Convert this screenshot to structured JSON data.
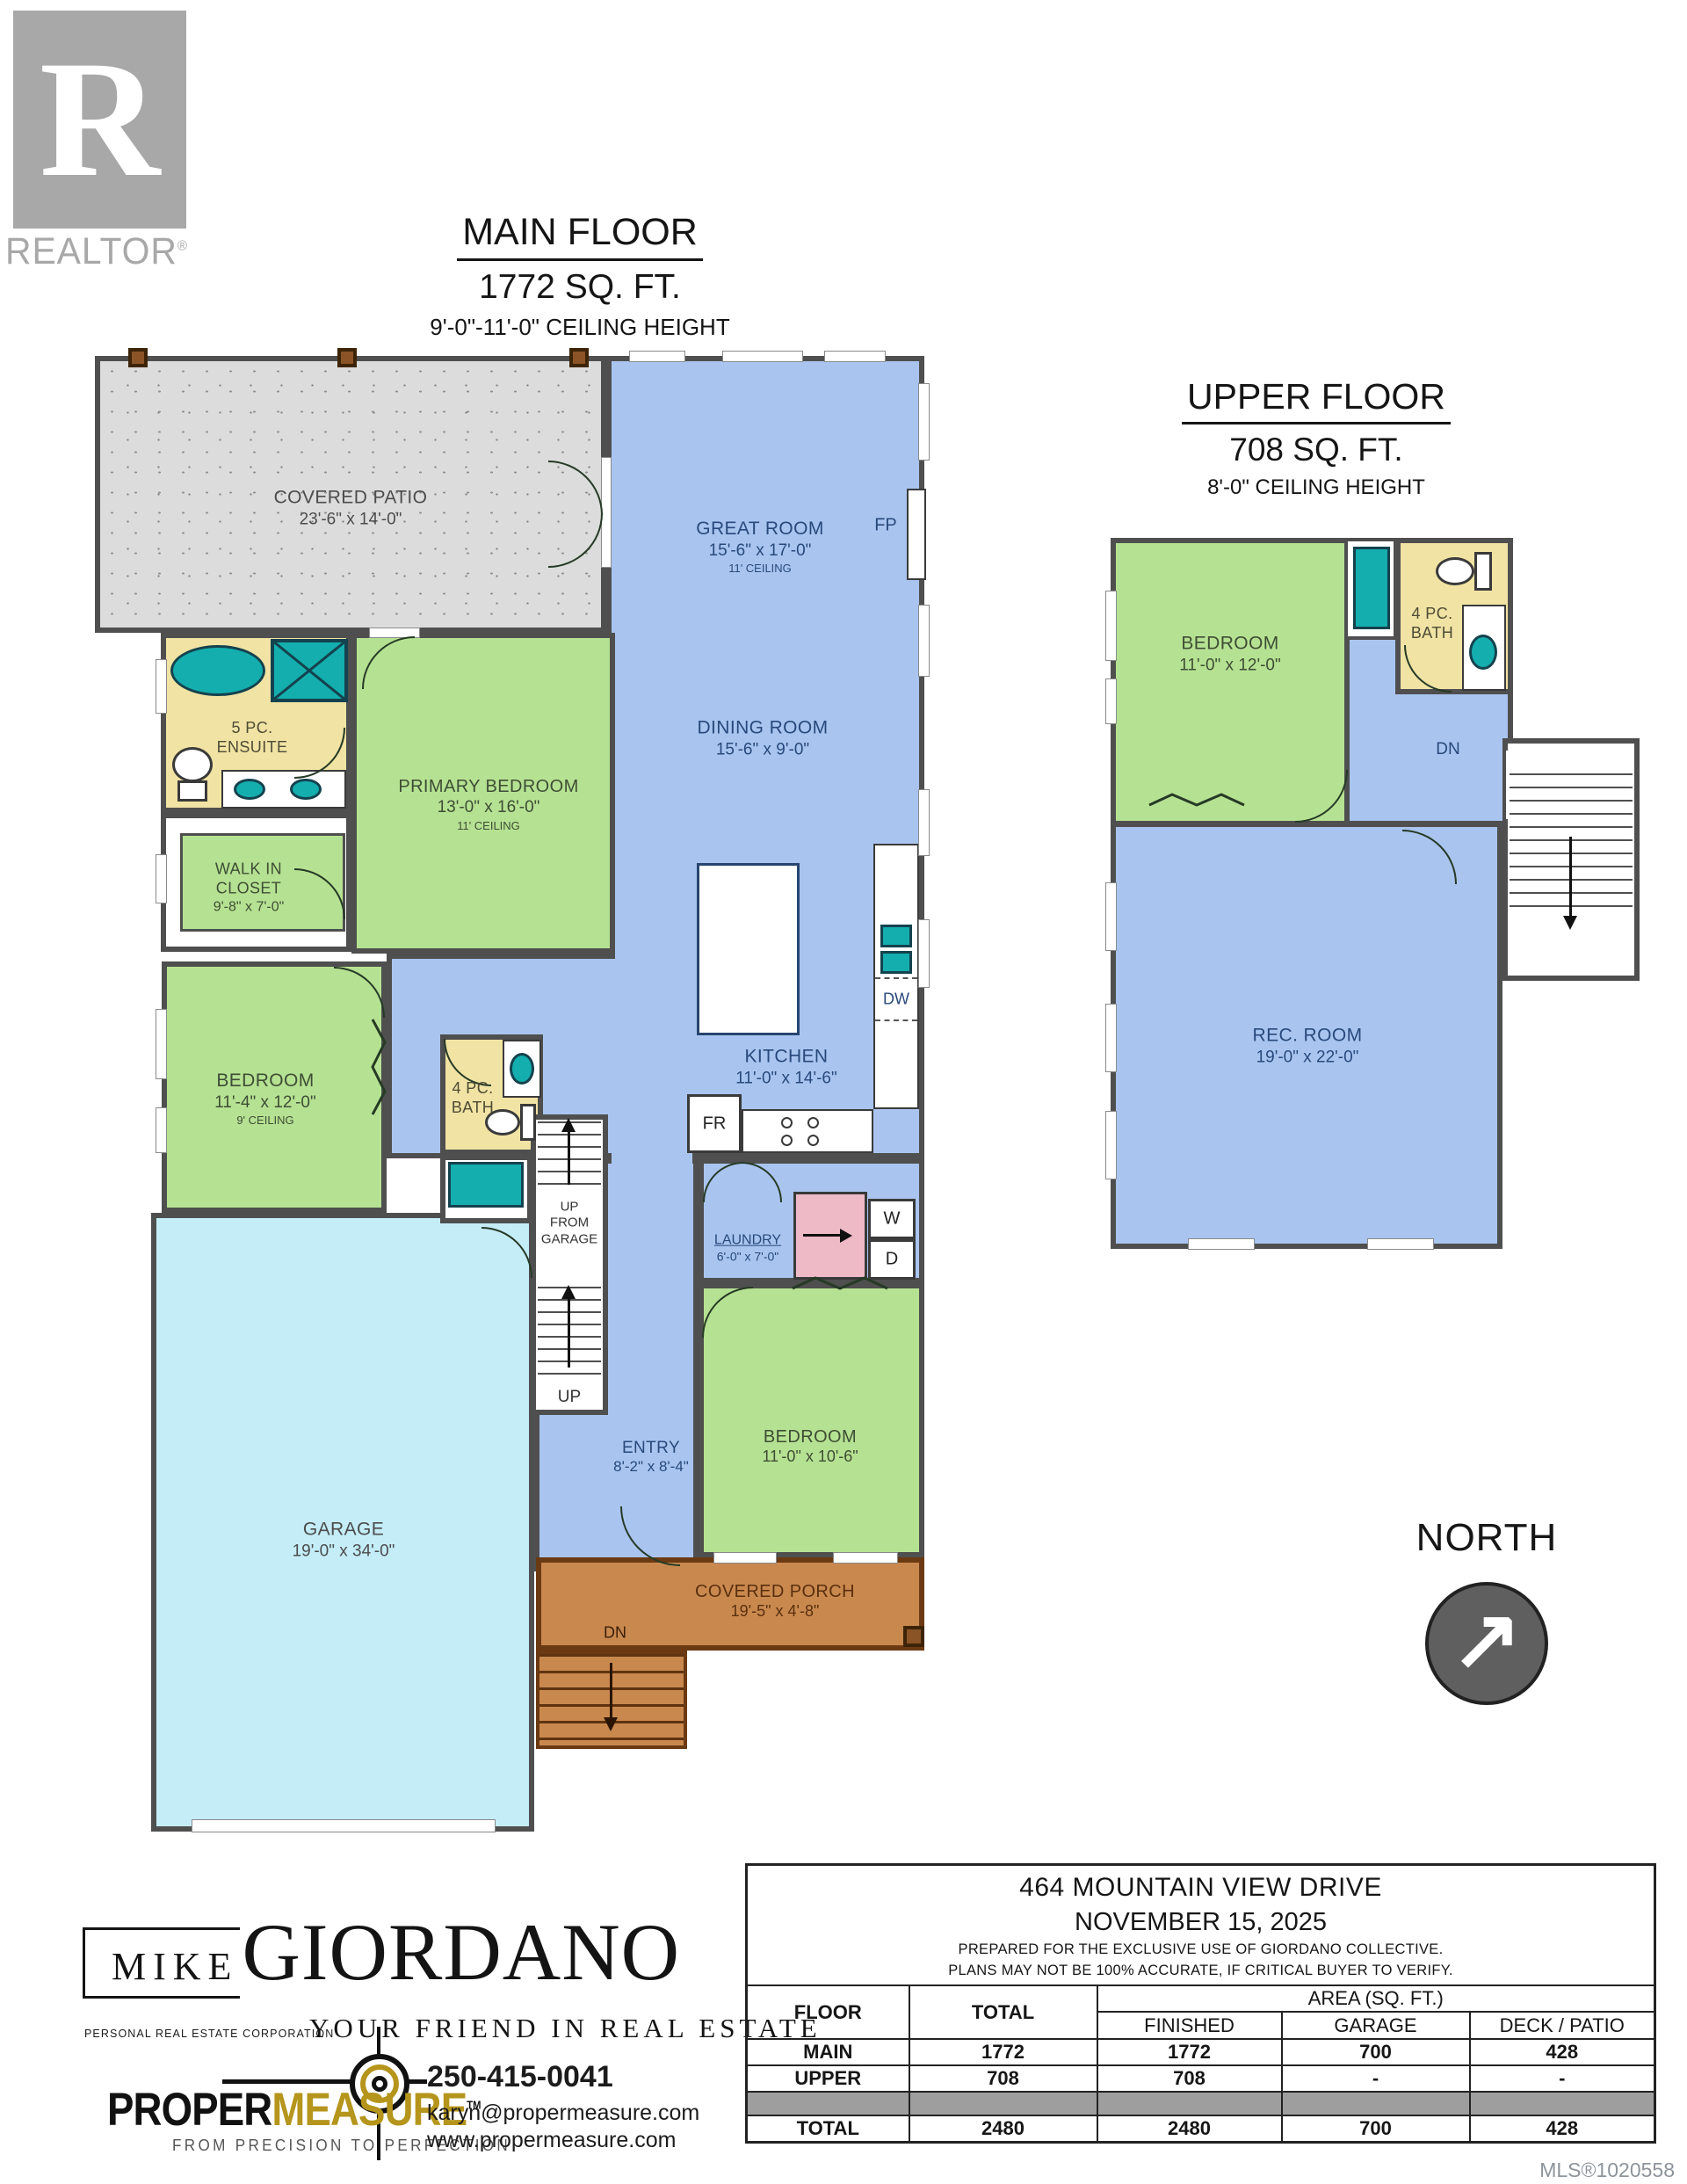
{
  "branding": {
    "realtor": {
      "letter": "R",
      "label": "REALTOR",
      "reg": "®"
    },
    "giordano": {
      "first": "MIKE",
      "last": "GIORDANO",
      "subtitle": "PERSONAL REAL ESTATE CORPORATION",
      "tagline": "YOUR FRIEND IN REAL ESTATE"
    },
    "propermeasure": {
      "word1": "PROPER",
      "word2": "MEASURE",
      "tm": "TM",
      "tagline": "FROM PRECISION TO PERFECTION",
      "phone": "250-415-0041",
      "email": "karyn@propermeasure.com",
      "website": "www.propermeasure.com"
    }
  },
  "main_floor": {
    "title": "MAIN FLOOR",
    "area": "1772 SQ. FT.",
    "ceiling": "9'-0\"-11'-0\" CEILING HEIGHT",
    "rooms": {
      "covered_patio": {
        "name": "COVERED PATIO",
        "dims": "23'-6\" x 14'-0\""
      },
      "great_room": {
        "name": "GREAT ROOM",
        "dims": "15'-6\" x 17'-0\"",
        "ceiling": "11' CEILING"
      },
      "dining_room": {
        "name": "DINING ROOM",
        "dims": "15'-6\" x 9'-0\""
      },
      "ensuite": {
        "line1": "5 PC.",
        "line2": "ENSUITE"
      },
      "primary_bedroom": {
        "name": "PRIMARY BEDROOM",
        "dims": "13'-0\" x 16'-0\"",
        "ceiling": "11' CEILING"
      },
      "walk_in_closet": {
        "line1": "WALK IN",
        "line2": "CLOSET",
        "dims": "9'-8\" x 7'-0\""
      },
      "bedroom2": {
        "name": "BEDROOM",
        "dims": "11'-4\" x 12'-0\"",
        "ceiling": "9' CEILING"
      },
      "bath": {
        "line1": "4 PC.",
        "line2": "BATH"
      },
      "kitchen": {
        "name": "KITCHEN",
        "dims": "11'-0\" x 14'-6\""
      },
      "laundry": {
        "name": "LAUNDRY",
        "dims": "6'-0\" x 7'-0\""
      },
      "entry": {
        "name": "ENTRY",
        "dims": "8'-2\" x 8'-4\""
      },
      "bedroom3": {
        "name": "BEDROOM",
        "dims": "11'-0\" x 10'-6\""
      },
      "garage": {
        "name": "GARAGE",
        "dims": "19'-0\" x 34'-0\""
      },
      "covered_porch": {
        "name": "COVERED PORCH",
        "dims": "19'-5\" x 4'-8\""
      }
    },
    "annotations": {
      "fp": "FP",
      "dw": "DW",
      "fr": "FR",
      "washer": "W",
      "dryer": "D",
      "up": "UP",
      "up_from_garage_1": "UP",
      "up_from_garage_2": "FROM",
      "up_from_garage_3": "GARAGE",
      "dn": "DN"
    }
  },
  "upper_floor": {
    "title": "UPPER FLOOR",
    "area": "708 SQ. FT.",
    "ceiling": "8'-0\" CEILING HEIGHT",
    "rooms": {
      "bedroom": {
        "name": "BEDROOM",
        "dims": "11'-0\" x 12'-0\""
      },
      "bath": {
        "line1": "4 PC.",
        "line2": "BATH"
      },
      "rec_room": {
        "name": "REC. ROOM",
        "dims": "19'-0\" x 22'-0\""
      }
    },
    "annotations": {
      "dn": "DN"
    }
  },
  "compass": {
    "label": "NORTH",
    "arrow": "↗"
  },
  "summary_table": {
    "address": "464 MOUNTAIN VIEW DRIVE",
    "date": "NOVEMBER 15, 2025",
    "note1": "PREPARED FOR THE EXCLUSIVE USE OF GIORDANO COLLECTIVE.",
    "note2": "PLANS MAY NOT BE 100% ACCURATE, IF CRITICAL BUYER TO VERIFY.",
    "col_floor": "FLOOR",
    "col_total": "TOTAL",
    "col_area": "AREA (SQ. FT.)",
    "col_finished": "FINISHED",
    "col_garage": "GARAGE",
    "col_deck": "DECK / PATIO",
    "rows": [
      {
        "floor": "MAIN",
        "total": "1772",
        "finished": "1772",
        "garage": "700",
        "deck": "428"
      },
      {
        "floor": "UPPER",
        "total": "708",
        "finished": "708",
        "garage": "-",
        "deck": "-"
      }
    ],
    "total_row": {
      "floor": "TOTAL",
      "total": "2480",
      "finished": "2480",
      "garage": "700",
      "deck": "428"
    }
  },
  "mls": "MLS®1020558"
}
